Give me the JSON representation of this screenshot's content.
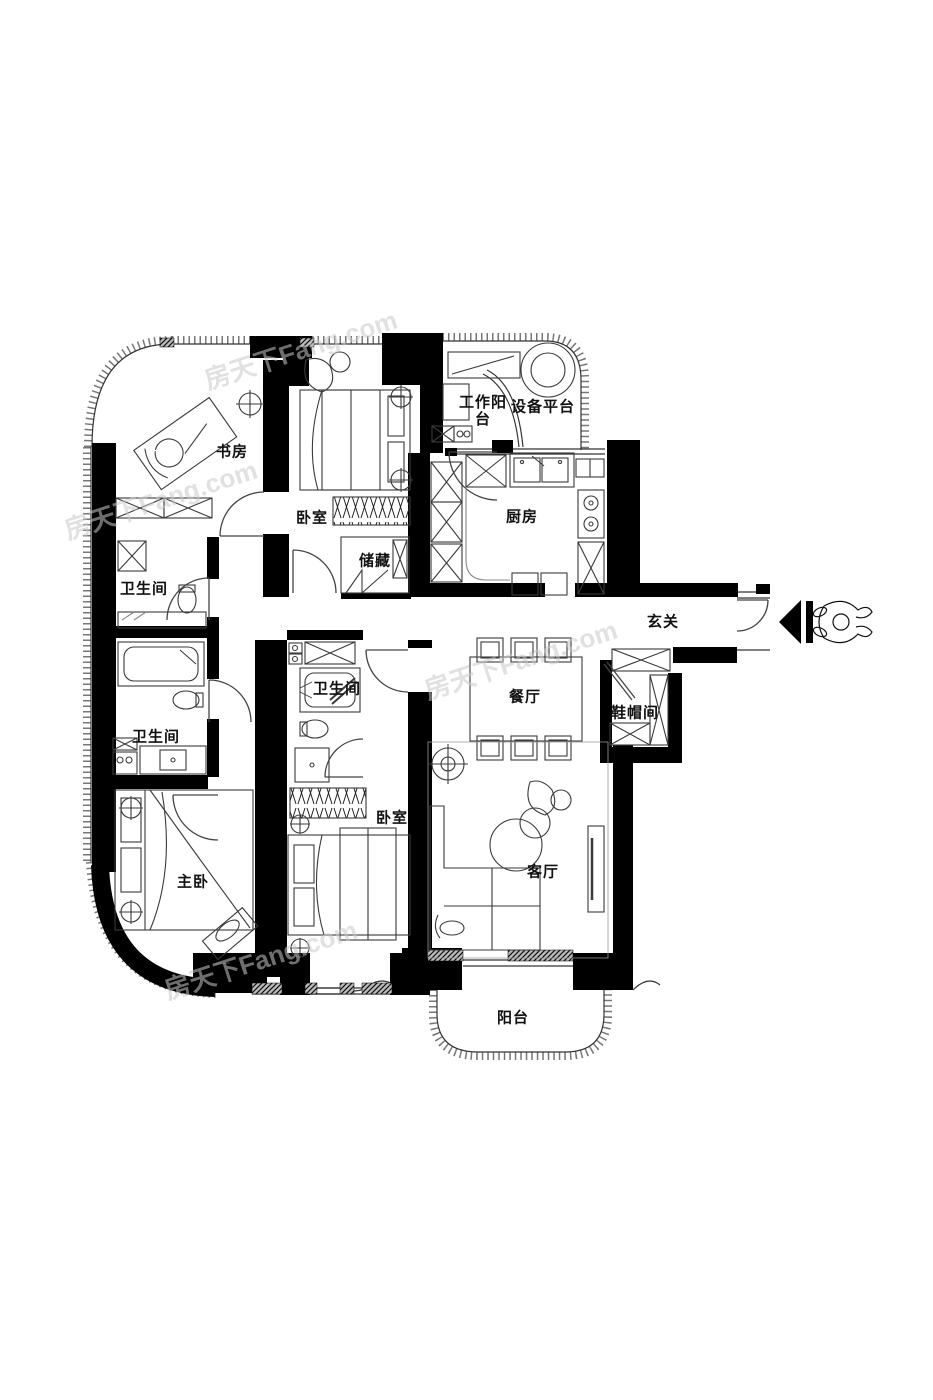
{
  "plan_title": "户型图",
  "watermark": {
    "text": "房天下Fang.com"
  },
  "colors": {
    "wall": "#000000",
    "furniture_line": "#3a3a3a",
    "window_line": "#8a8a8a",
    "watermark": "#c9c9c9"
  },
  "rooms": [
    {
      "name": "study",
      "label": "书房"
    },
    {
      "name": "bedroom-top",
      "label": "卧室"
    },
    {
      "name": "work-balcony",
      "label": "工作阳台"
    },
    {
      "name": "equipment-platform",
      "label": "设备平台"
    },
    {
      "name": "kitchen",
      "label": "厨房"
    },
    {
      "name": "entry-hall",
      "label": "玄关"
    },
    {
      "name": "storage",
      "label": "储藏"
    },
    {
      "name": "bathroom-1",
      "label": "卫生间"
    },
    {
      "name": "bathroom-2",
      "label": "卫生间"
    },
    {
      "name": "bathroom-3",
      "label": "卫生间"
    },
    {
      "name": "dining-room",
      "label": "餐厅"
    },
    {
      "name": "cloakroom",
      "label": "鞋帽间"
    },
    {
      "name": "bedroom-mid",
      "label": "卧室"
    },
    {
      "name": "master-bedroom",
      "label": "主卧"
    },
    {
      "name": "living-room",
      "label": "客厅"
    },
    {
      "name": "balcony",
      "label": "阳台"
    }
  ]
}
